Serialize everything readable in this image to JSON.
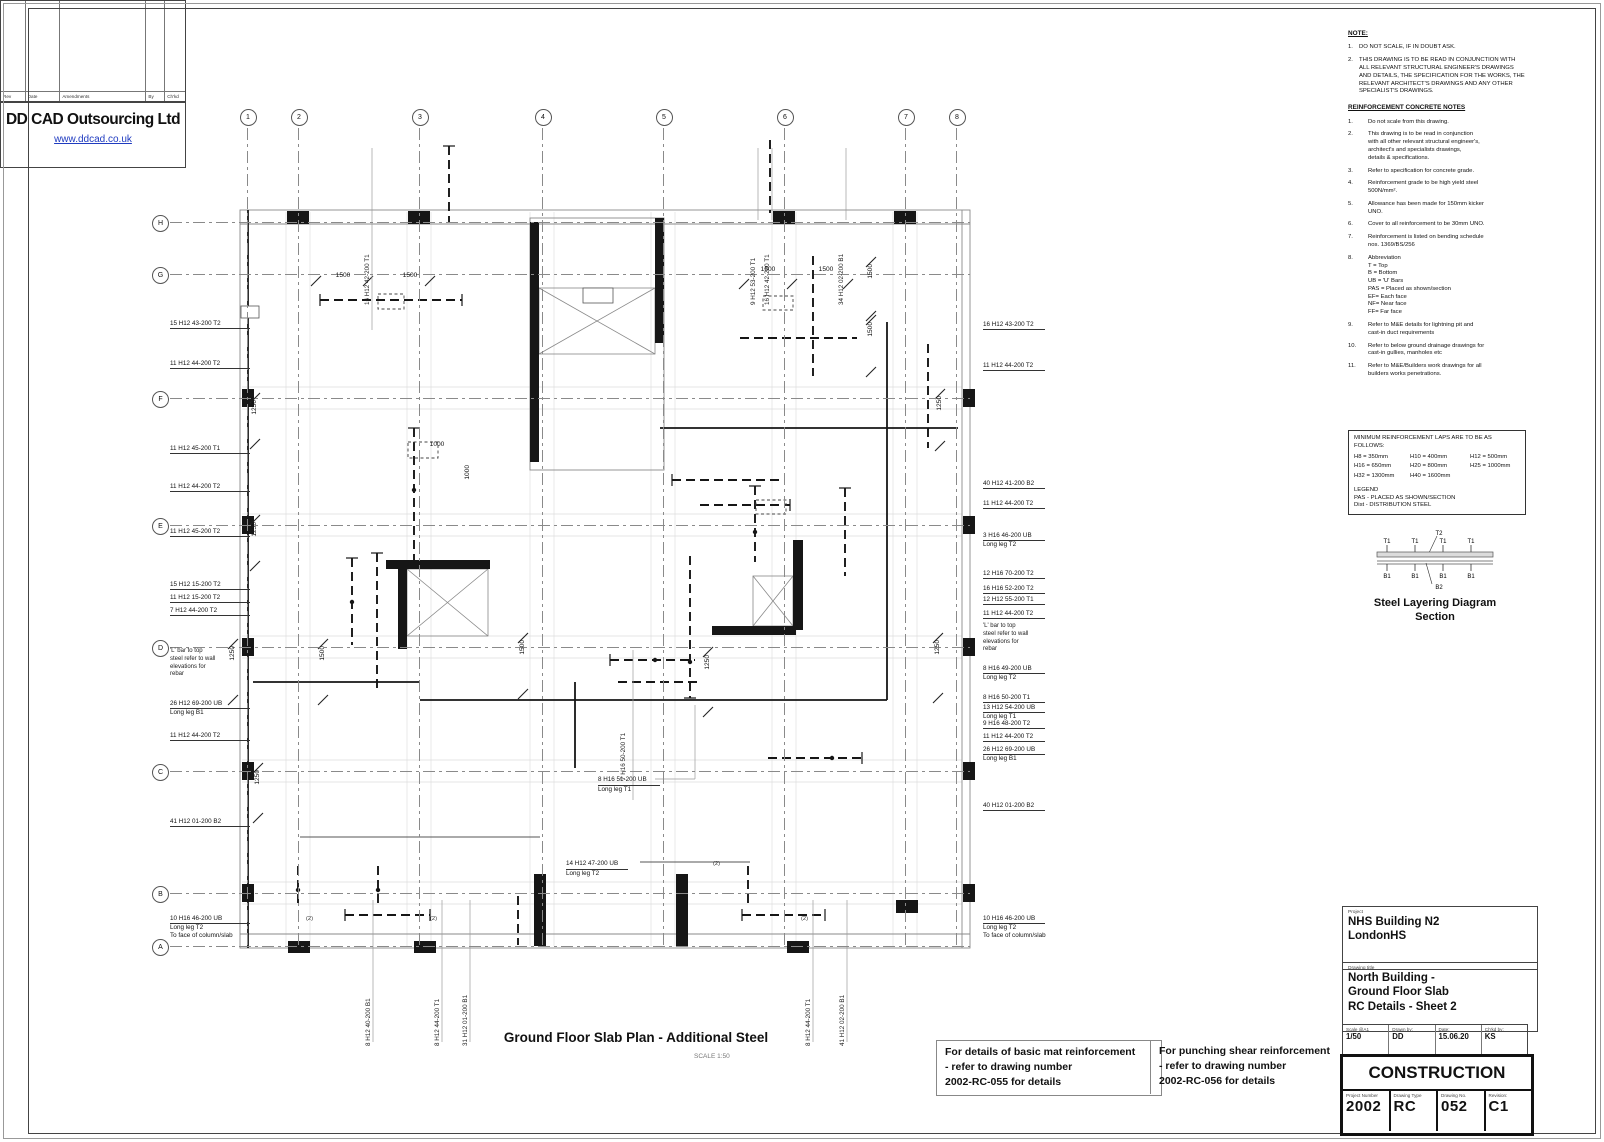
{
  "plan": {
    "title": "Ground Floor Slab Plan - Additional Steel",
    "scale_note": "SCALE 1:50",
    "grid": {
      "cols": [
        {
          "label": "1",
          "x": 247
        },
        {
          "label": "2",
          "x": 298
        },
        {
          "label": "3",
          "x": 419
        },
        {
          "label": "4",
          "x": 542
        },
        {
          "label": "5",
          "x": 663
        },
        {
          "label": "6",
          "x": 784
        },
        {
          "label": "7",
          "x": 905
        },
        {
          "label": "8",
          "x": 956
        }
      ],
      "rows": [
        {
          "label": "H",
          "y": 222
        },
        {
          "label": "G",
          "y": 274
        },
        {
          "label": "F",
          "y": 398
        },
        {
          "label": "E",
          "y": 525
        },
        {
          "label": "D",
          "y": 647
        },
        {
          "label": "C",
          "y": 771
        },
        {
          "label": "B",
          "y": 893
        },
        {
          "label": "A",
          "y": 946
        }
      ]
    },
    "left_labels": [
      {
        "y": 320,
        "lines": [
          "15 H12 43-200 T2"
        ]
      },
      {
        "y": 360,
        "lines": [
          "11 H12 44-200 T2"
        ]
      },
      {
        "y": 445,
        "lines": [
          "11 H12 45-200 T1"
        ]
      },
      {
        "y": 483,
        "lines": [
          "11 H12 44-200 T2"
        ]
      },
      {
        "y": 528,
        "lines": [
          "11 H12 45-200 T2"
        ]
      },
      {
        "y": 581,
        "lines": [
          "15 H12 15-200 T2"
        ]
      },
      {
        "y": 594,
        "lines": [
          "11 H12 15-200 T2"
        ]
      },
      {
        "y": 607,
        "lines": [
          "7 H12 44-200 T2"
        ]
      },
      {
        "y": 648,
        "note": true,
        "lines": [
          "'L' bar to top",
          "steel refer to wall",
          "elevations for",
          "rebar"
        ]
      },
      {
        "y": 700,
        "lines": [
          "26 H12 69-200 UB",
          "Long leg B1"
        ]
      },
      {
        "y": 732,
        "lines": [
          "11 H12 44-200 T2"
        ]
      },
      {
        "y": 818,
        "lines": [
          "41 H12 01-200 B2"
        ]
      },
      {
        "y": 915,
        "lines": [
          "10 H16 46-200 UB",
          "Long leg T2",
          "To face of column/slab"
        ]
      }
    ],
    "right_labels": [
      {
        "y": 321,
        "lines": [
          "16 H12 43-200 T2"
        ]
      },
      {
        "y": 362,
        "lines": [
          "11 H12 44-200 T2"
        ]
      },
      {
        "y": 480,
        "lines": [
          "40 H12 41-200 B2"
        ]
      },
      {
        "y": 500,
        "lines": [
          "11 H12 44-200 T2"
        ]
      },
      {
        "y": 532,
        "lines": [
          "3 H16 46-200 UB",
          "Long leg T2"
        ]
      },
      {
        "y": 570,
        "lines": [
          "12 H16 70-200 T2"
        ]
      },
      {
        "y": 585,
        "lines": [
          "16 H16 52-200 T2"
        ]
      },
      {
        "y": 596,
        "lines": [
          "12 H12 55-200 T1"
        ]
      },
      {
        "y": 610,
        "lines": [
          "11 H12 44-200 T2"
        ]
      },
      {
        "y": 623,
        "note": true,
        "lines": [
          "'L' bar to top",
          "steel refer to wall",
          "elevations for",
          "rebar"
        ]
      },
      {
        "y": 665,
        "lines": [
          "8 H16 49-200 UB",
          "Long leg T2"
        ]
      },
      {
        "y": 694,
        "lines": [
          "8 H16 50-200 T1"
        ]
      },
      {
        "y": 704,
        "lines": [
          "13 H12 54-200 UB",
          "Long leg T1"
        ]
      },
      {
        "y": 720,
        "lines": [
          "9 H16 48-200 T2"
        ]
      },
      {
        "y": 733,
        "lines": [
          "11 H12 44-200 T2"
        ]
      },
      {
        "y": 746,
        "lines": [
          "26 H12 69-200 UB",
          "Long leg B1"
        ]
      },
      {
        "y": 802,
        "lines": [
          "40 H12 01-200 B2"
        ]
      },
      {
        "y": 915,
        "lines": [
          "10 H16 46-200 UB",
          "Long leg T2",
          "To face of column/slab"
        ]
      }
    ],
    "top_labels": [
      {
        "x": 372,
        "text": "16 H12 42-200 T1"
      },
      {
        "x": 758,
        "text": "9 H12 53-200 T1"
      },
      {
        "x": 772,
        "text": "16 H12 42-200 T1"
      },
      {
        "x": 846,
        "text": "34 H12 02-200 B1"
      }
    ],
    "bottom_labels": [
      {
        "x": 373,
        "text": "8 H12 40-200 B1"
      },
      {
        "x": 442,
        "text": "8 H12 44-200 T1"
      },
      {
        "x": 470,
        "text": "31 H12 01-200 B1"
      },
      {
        "x": 813,
        "text": "8 H12 44-200 T1"
      },
      {
        "x": 847,
        "text": "41 H12 02-200 B1"
      }
    ],
    "center_labels": [
      {
        "x": 598,
        "y": 776,
        "lines": [
          "8 H16 51-200 UB",
          "Long leg T1"
        ]
      },
      {
        "x": 566,
        "y": 860,
        "lines": [
          "14 H12 47-200 UB",
          "Long leg T2"
        ]
      }
    ],
    "center_vertical_labels": [
      {
        "x": 628,
        "y": 700,
        "text": "7 H16 50-200 T1"
      }
    ],
    "dims": [
      {
        "t": "1500",
        "x": 343,
        "y": 272
      },
      {
        "t": "1500",
        "x": 410,
        "y": 272
      },
      {
        "t": "1500",
        "x": 768,
        "y": 266
      },
      {
        "t": "1500",
        "x": 826,
        "y": 266
      },
      {
        "t": "1000",
        "x": 437,
        "y": 441
      },
      {
        "t": "1500",
        "x": 871,
        "y": 264,
        "r": 1
      },
      {
        "t": "1500",
        "x": 871,
        "y": 322,
        "r": 1
      },
      {
        "t": "1250",
        "x": 940,
        "y": 396,
        "r": 1
      },
      {
        "t": "1250",
        "x": 255,
        "y": 400,
        "r": 1
      },
      {
        "t": "1250",
        "x": 255,
        "y": 522,
        "r": 1
      },
      {
        "t": "1250",
        "x": 233,
        "y": 646,
        "r": 1
      },
      {
        "t": "1250",
        "x": 258,
        "y": 770,
        "r": 1
      },
      {
        "t": "1500",
        "x": 323,
        "y": 646,
        "r": 1
      },
      {
        "t": "1500",
        "x": 523,
        "y": 640,
        "r": 1
      },
      {
        "t": "1250",
        "x": 708,
        "y": 655,
        "r": 1
      },
      {
        "t": "1250",
        "x": 938,
        "y": 640,
        "r": 1
      },
      {
        "t": "1000",
        "x": 468,
        "y": 465,
        "r": 1
      }
    ],
    "brackets": [
      {
        "t": "(2)",
        "x": 306,
        "y": 916
      },
      {
        "t": "(2)",
        "x": 430,
        "y": 916
      },
      {
        "t": "(2)",
        "x": 801,
        "y": 916
      },
      {
        "t": "(2)",
        "x": 713,
        "y": 861
      }
    ]
  },
  "ref_notes": [
    {
      "lines": [
        "For details of basic mat reinforcement",
        "- refer to drawing number",
        "2002-RC-055 for details"
      ]
    },
    {
      "lines": [
        "For punching shear reinforcement",
        "- refer to drawing number",
        "2002-RC-056 for details"
      ]
    }
  ],
  "notes_panel": {
    "note_heading": "NOTE:",
    "notes": [
      "DO NOT SCALE, IF IN DOUBT ASK.",
      "THIS DRAWING IS TO BE READ IN CONJUNCTION WITH ALL RELEVANT STRUCTURAL ENGINEER'S DRAWINGS AND DETAILS, THE SPECIFICATION FOR THE WORKS, THE RELEVANT ARCHITECT'S DRAWINGS AND ANY OTHER SPECIALIST'S DRAWINGS."
    ],
    "rc_heading": "REINFORCEMENT CONCRETE NOTES",
    "rc_notes": [
      {
        "num": "1.",
        "text": "Do not scale from this drawing."
      },
      {
        "num": "2.",
        "text": "This drawing is to be read in conjunction\nwith all other relevant structural engineer's,\narchitect's and specialists drawings,\ndetails & specifications."
      },
      {
        "num": "3.",
        "text": "Refer to specification for concrete grade."
      },
      {
        "num": "4.",
        "text": "Reinforcement grade to be high yield steel\n500N/mm²."
      },
      {
        "num": "5.",
        "text": "Allowance has been made for 150mm kicker\nUNO."
      },
      {
        "num": "6.",
        "text": "Cover to all reinforcement to be 30mm UNO."
      },
      {
        "num": "7.",
        "text": "Reinforcement is listed on bending schedule\nnos. 1369/BS/256"
      },
      {
        "num": "8.",
        "text": "Abbreviation\nT = Top\nB = Bottom\nUB = 'U' Bars\nPAS = Placed as shown/section\nEF= Each face\nNF= Near face\nFF= Far face"
      },
      {
        "num": "9.",
        "text": "Refer to M&E details for lightning pit and\ncast-in duct requirements"
      },
      {
        "num": "10.",
        "text": "Refer to below ground drainage drawings for\ncast-in gullies, manholes etc"
      },
      {
        "num": "11.",
        "text": "Refer to M&E/Builders work drawings for all\nbuilders works penetrations."
      }
    ],
    "laps_heading": "MINIMUM REINFORCEMENT LAPS ARE TO BE AS FOLLOWS:",
    "laps": [
      "H8  =  350mm",
      "H10  =  400mm",
      "H12   =  500mm",
      "H16  =  650mm",
      "H20  =  800mm",
      "H25  =  1000mm",
      "H32  =  1300mm",
      "H40  =  1600mm"
    ],
    "legend_title": "LEGEND",
    "legend_lines": [
      "PAS - PLACED AS SHOWN/SECTION",
      "Dist - DISTRIBUTION STEEL"
    ],
    "layering": {
      "title1": "Steel Layering Diagram",
      "title2": "Section",
      "top_labels": [
        "T1",
        "T1",
        "T1",
        "T1"
      ],
      "mid_label": "T2",
      "bottom_labels": [
        "B1",
        "B1",
        "B1",
        "B1"
      ],
      "below_label": "B2"
    }
  },
  "title_block": {
    "rev_header": [
      "Rev",
      "Date",
      "Amendments",
      "By",
      "Ch'kd"
    ],
    "company": "DD CAD Outsourcing Ltd",
    "website": "www.ddcad.co.uk",
    "project_label": "Project",
    "project_lines": [
      "NHS Building N2",
      "LondonHS"
    ],
    "drawing_title_label": "Drawing title",
    "drawing_title_lines": [
      "North Building -",
      "Ground Floor Slab",
      "RC Details - Sheet 2"
    ],
    "meta": [
      {
        "label": "Scale @A1",
        "value": "1/50"
      },
      {
        "label": "Drawn by:",
        "value": "DD"
      },
      {
        "label": "Date:",
        "value": "15.06.20"
      },
      {
        "label": "Ch'kd by:",
        "value": "KS"
      }
    ],
    "status": "CONSTRUCTION",
    "numbers": [
      {
        "label": "Project Number",
        "value": "2002"
      },
      {
        "label": "Drawing Type",
        "value": "RC"
      },
      {
        "label": "Drawing No.",
        "value": "052"
      },
      {
        "label": "Revision:",
        "value": "C1"
      }
    ]
  }
}
